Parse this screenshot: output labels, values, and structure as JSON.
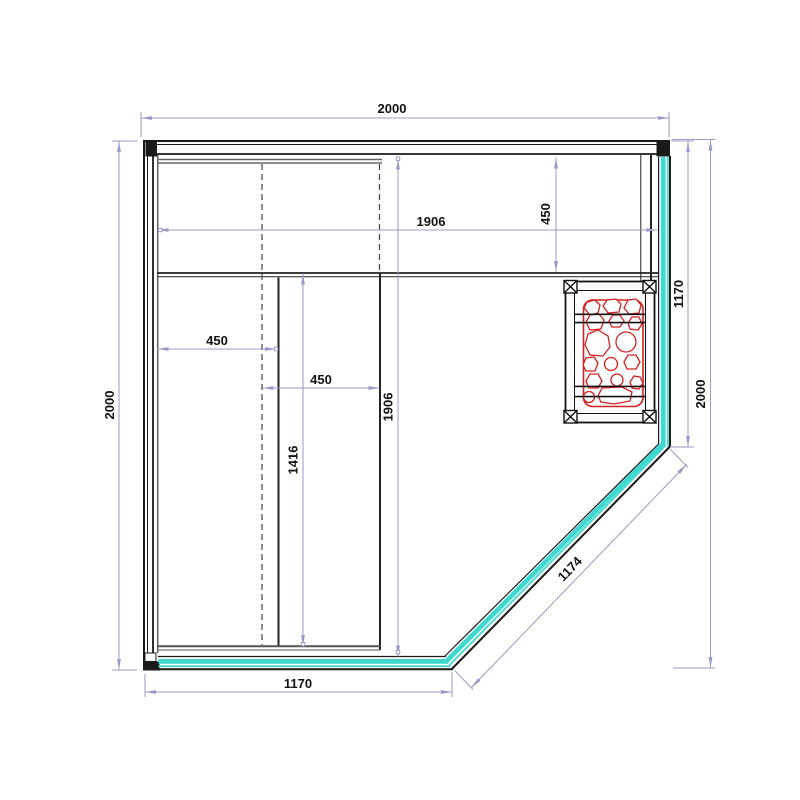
{
  "drawing": {
    "dimensions": {
      "top_width": "2000",
      "left_height": "2000",
      "interior_width": "1906",
      "seat_depth_right": "450",
      "glass_right": "1170",
      "right_height": "2000",
      "seat_depth_left": "450",
      "lower_bench_width": "450",
      "bench_length": "1416",
      "interior_depth": "1906",
      "glass_bottom": "1170",
      "glass_diagonal": "1174"
    },
    "colors": {
      "glass": "#3fd8cf",
      "heater_stones": "#d42020",
      "dimension": "#9a9ac8",
      "wall": "#1a1a1a",
      "hidden_line": "#444444",
      "bench_line": "#555555"
    }
  }
}
